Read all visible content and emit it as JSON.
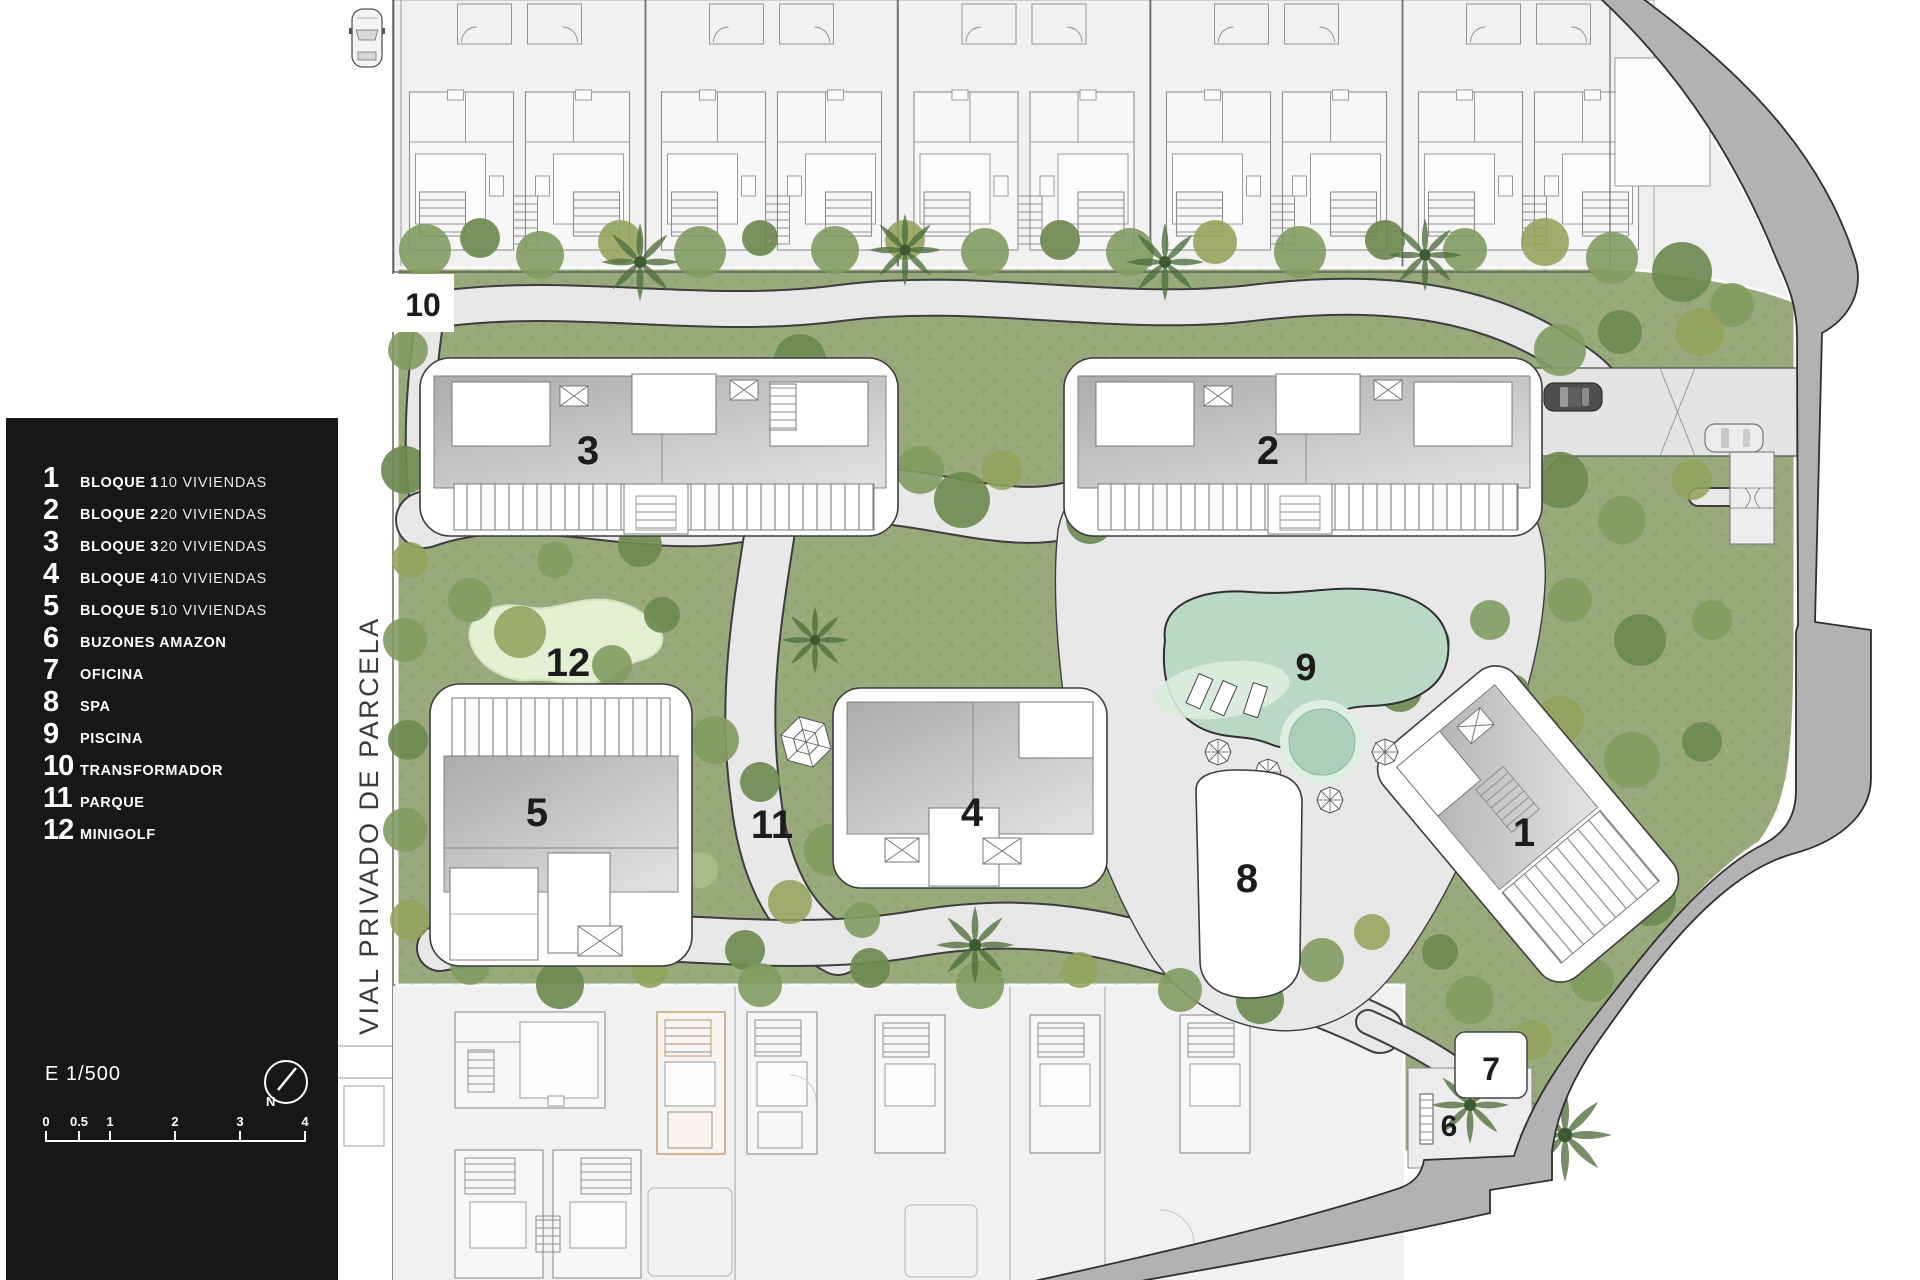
{
  "legend": {
    "items": [
      {
        "num": "1",
        "label": "BLOQUE 1",
        "detail": "10 VIVIENDAS"
      },
      {
        "num": "2",
        "label": "BLOQUE 2",
        "detail": "20 VIVIENDAS"
      },
      {
        "num": "3",
        "label": "BLOQUE 3",
        "detail": "20 VIVIENDAS"
      },
      {
        "num": "4",
        "label": "BLOQUE 4",
        "detail": "10 VIVIENDAS"
      },
      {
        "num": "5",
        "label": "BLOQUE 5",
        "detail": "10 VIVIENDAS"
      },
      {
        "num": "6",
        "label": "BUZONES AMAZON",
        "detail": ""
      },
      {
        "num": "7",
        "label": "OFICINA",
        "detail": ""
      },
      {
        "num": "8",
        "label": "SPA",
        "detail": ""
      },
      {
        "num": "9",
        "label": "PISCINA",
        "detail": ""
      },
      {
        "num": "10",
        "label": "TRANSFORMADOR",
        "detail": ""
      },
      {
        "num": "11",
        "label": "PARQUE",
        "detail": ""
      },
      {
        "num": "12",
        "label": "MINIGOLF",
        "detail": ""
      }
    ]
  },
  "scale": {
    "text": "E 1/500"
  },
  "compass": {
    "label": "N"
  },
  "scalebar": {
    "ticks": [
      "0",
      "0.5",
      "1",
      "2",
      "3",
      "4"
    ]
  },
  "road": {
    "label": "VIAL PRIVADO DE PARCELA"
  },
  "plan": {
    "markers": {
      "block1": "1",
      "block2": "2",
      "block3": "3",
      "block4": "4",
      "block5": "5",
      "buzones": "6",
      "oficina": "7",
      "spa": "8",
      "piscina": "9",
      "transformador": "10",
      "parque": "11",
      "minigolf": "12"
    }
  },
  "colors": {
    "panel_bg": "#171717",
    "text_light": "#ffffff",
    "grass": "#98aa7c",
    "tree_dark": "#6d8a50",
    "pool_water": "#b9d9c6",
    "pool_shallow": "#ddecdf",
    "hardscape": "#e8e8e8",
    "road_gray": "#b2b2b2",
    "outline": "#3d3d3d",
    "parcel_bg": "#f1f1f1",
    "highlight_tan": "#c19b73"
  }
}
